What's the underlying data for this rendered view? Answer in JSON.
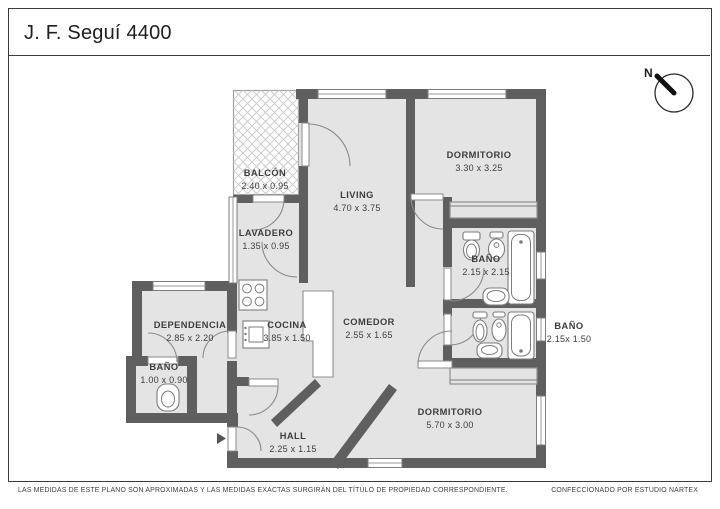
{
  "header": {
    "title": "J. F. Seguí 4400"
  },
  "compass": {
    "north_label": "N"
  },
  "rooms": [
    {
      "name": "BALCÓN",
      "dims": "2.40 x 0.95"
    },
    {
      "name": "LIVING",
      "dims": "4.70 x 3.75"
    },
    {
      "name": "DORMITORIO",
      "dims": "3.30 x 3.25"
    },
    {
      "name": "LAVADERO",
      "dims": "1.35 x 0.95"
    },
    {
      "name": "BAÑO",
      "dims": "2.15 x 2.15"
    },
    {
      "name": "DEPENDENCIA",
      "dims": "2.85 x 2.20"
    },
    {
      "name": "COCINA",
      "dims": "3.85 x 1.50"
    },
    {
      "name": "COMEDOR",
      "dims": "2.55 x 1.65"
    },
    {
      "name": "BAÑO",
      "dims": "2.15x 1.50"
    },
    {
      "name": "BAÑO",
      "dims": "1.00 x 0.90"
    },
    {
      "name": "HALL",
      "dims": "2.25 x 1.15"
    },
    {
      "name": "DORMITORIO",
      "dims": "5.70 x 3.00"
    }
  ],
  "footer": {
    "left": "LAS MEDIDAS  DE ESTE PLANO SON APROXIMADAS Y LAS MEDIDAS EXACTAS SURGIRÁN DEL TÍTULO DE PROPIEDAD CORRESPONDIENTE.",
    "right": "CONFECCIONADO POR ESTUDIO NARTEX"
  },
  "colors": {
    "wall": "#5f5f5f",
    "floor": "#e4e4e4",
    "frame": "#3b3b3b",
    "hatch": "#cdcdcd"
  }
}
